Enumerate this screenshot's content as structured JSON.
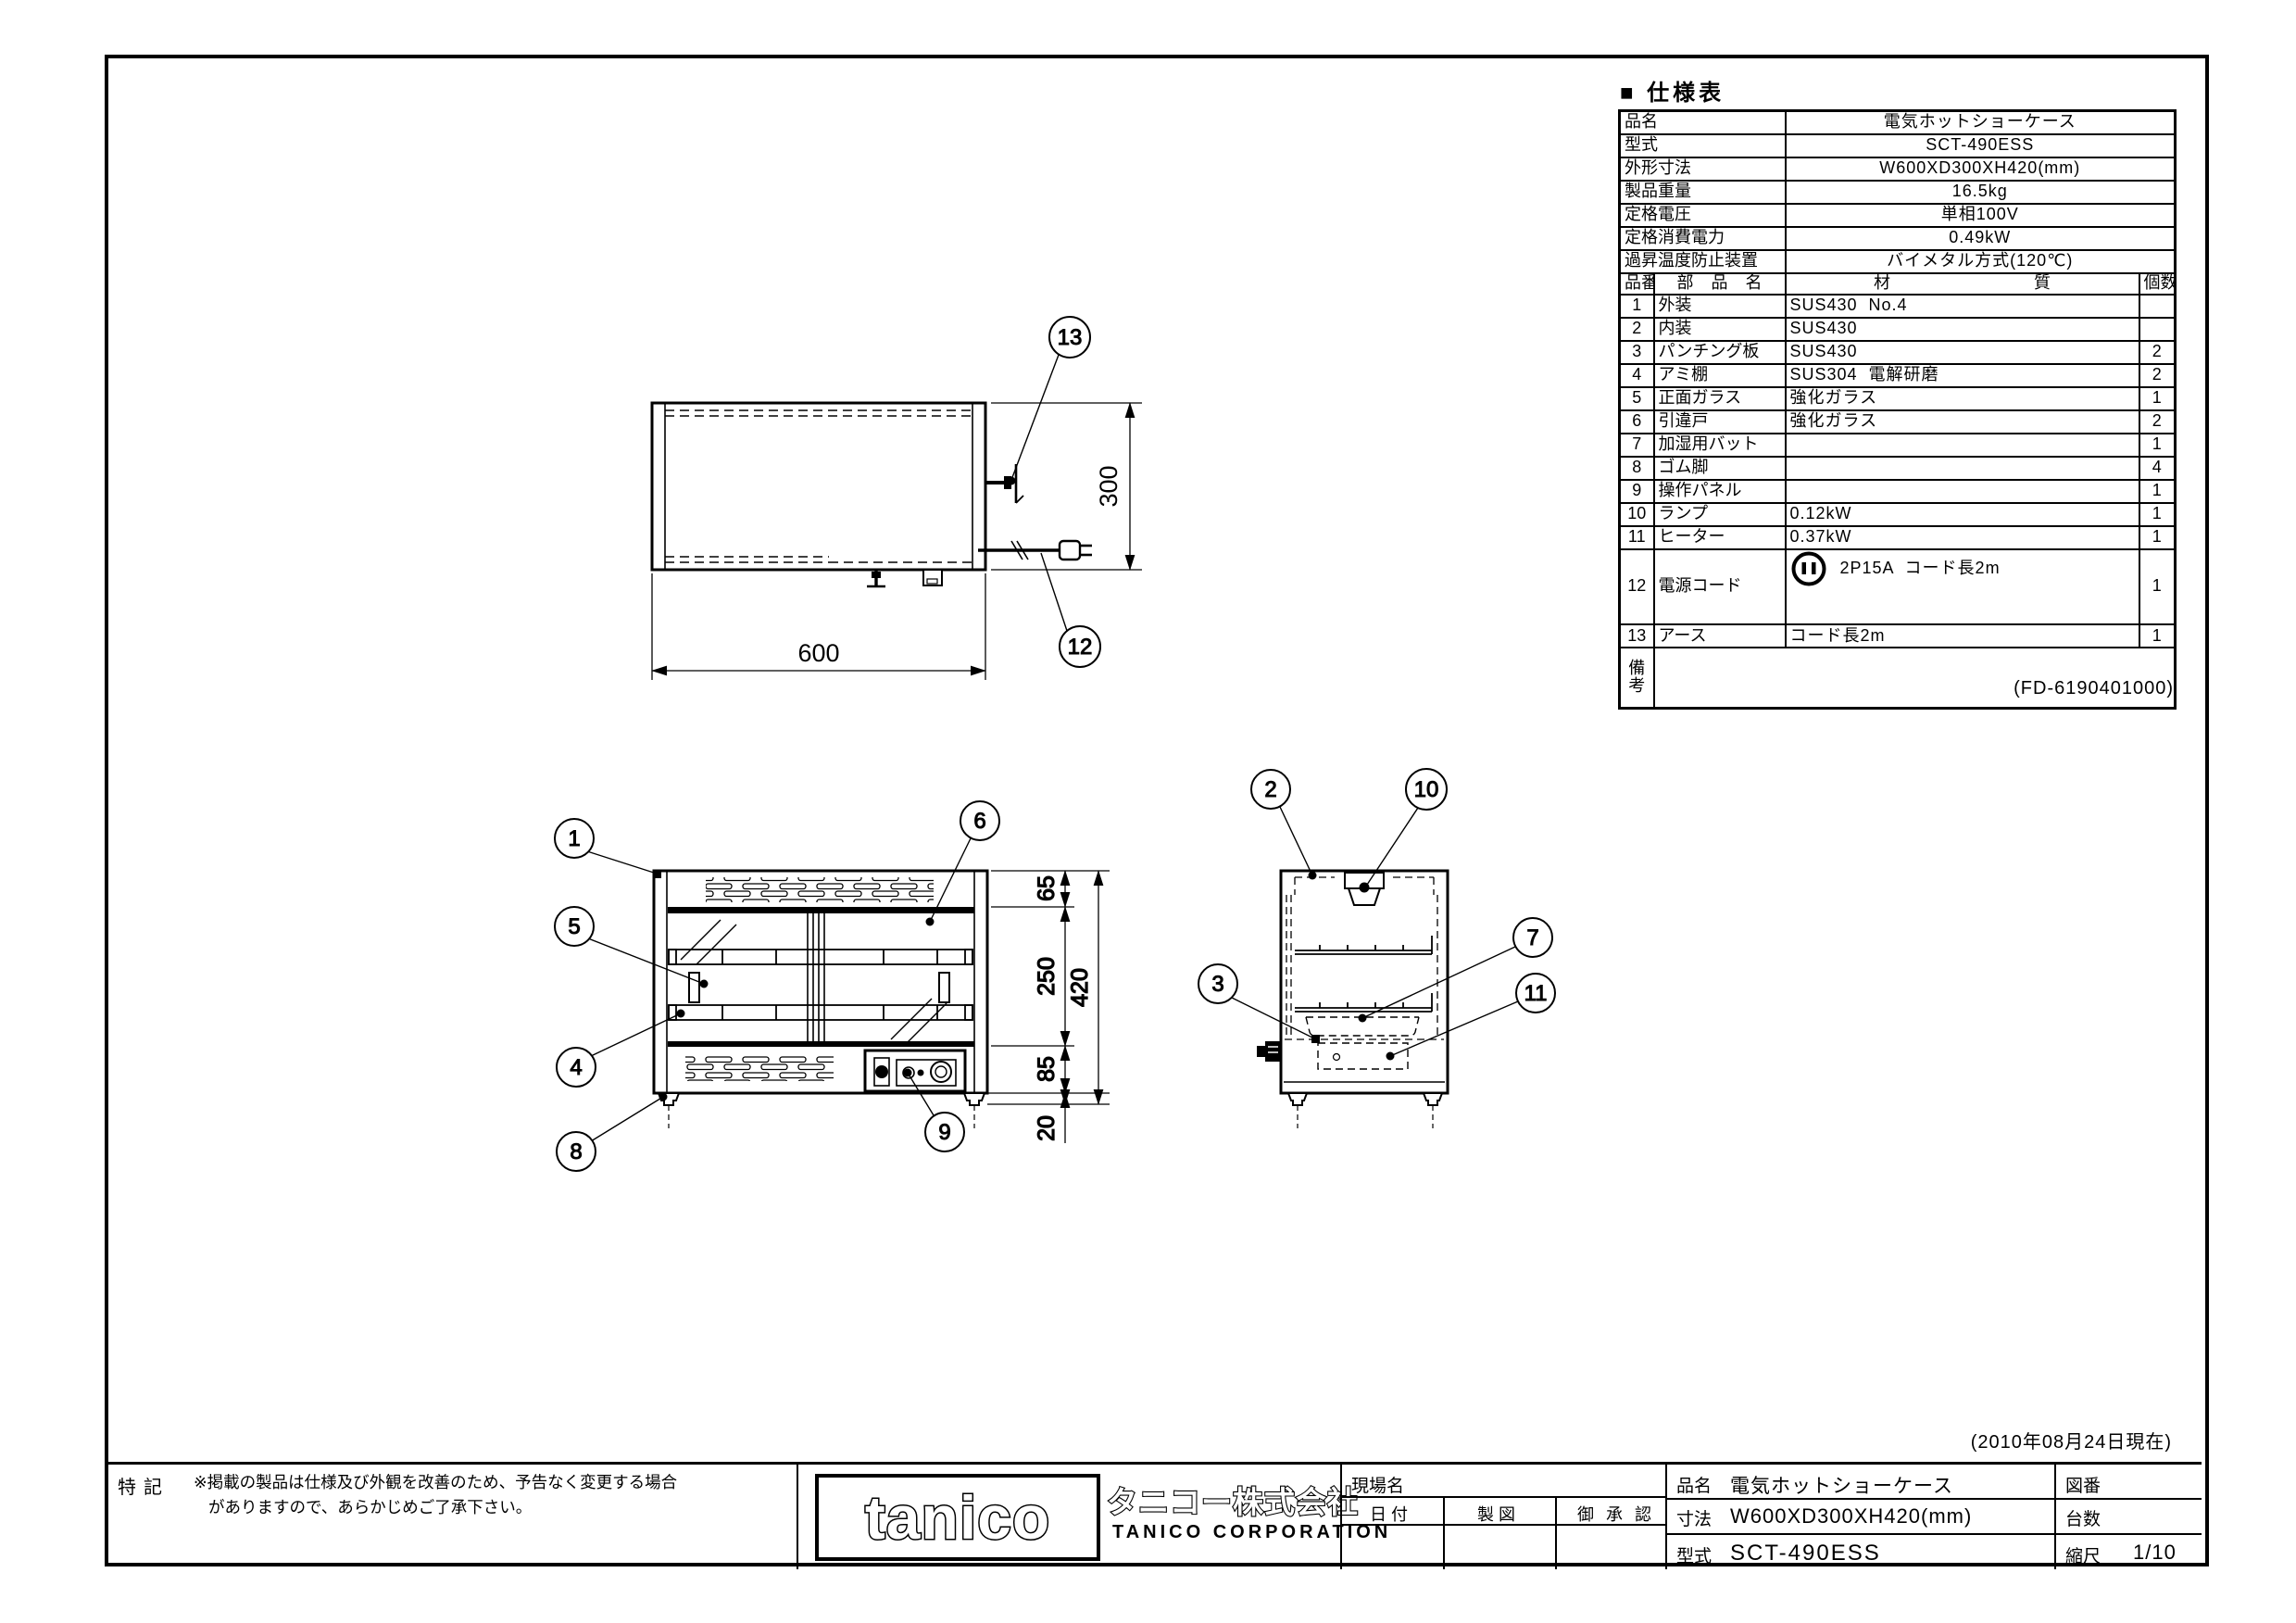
{
  "doc": {
    "spec_title": "■ 仕様表",
    "doc_code": "(FD-6190401000)",
    "as_of_date": "(2010年08月24日現在)"
  },
  "spec": {
    "info_rows": [
      {
        "label": "品名",
        "value": "電気ホットショーケース"
      },
      {
        "label": "型式",
        "value": "SCT-490ESS"
      },
      {
        "label": "外形寸法",
        "value": "W600XD300XH420(mm)"
      },
      {
        "label": "製品重量",
        "value": "16.5kg"
      },
      {
        "label": "定格電圧",
        "value": "単相100V"
      },
      {
        "label": "定格消費電力",
        "value": "0.49kW"
      },
      {
        "label": "過昇温度防止装置",
        "value": "バイメタル方式(120℃)"
      }
    ],
    "header": {
      "no": "品番",
      "name": "部 品 名",
      "material": "材 質",
      "qty": "個数"
    },
    "parts": [
      {
        "no": "1",
        "name": "外装",
        "material": "SUS430  No.4",
        "qty": ""
      },
      {
        "no": "2",
        "name": "内装",
        "material": "SUS430",
        "qty": ""
      },
      {
        "no": "3",
        "name": "パンチング板",
        "material": "SUS430",
        "qty": "2"
      },
      {
        "no": "4",
        "name": "アミ棚",
        "material": "SUS304  電解研磨",
        "qty": "2"
      },
      {
        "no": "5",
        "name": "正面ガラス",
        "material": "強化ガラス",
        "qty": "1"
      },
      {
        "no": "6",
        "name": "引違戸",
        "material": "強化ガラス",
        "qty": "2"
      },
      {
        "no": "7",
        "name": "加湿用バット",
        "material": "",
        "qty": "1"
      },
      {
        "no": "8",
        "name": "ゴム脚",
        "material": "",
        "qty": "4"
      },
      {
        "no": "9",
        "name": "操作パネル",
        "material": "",
        "qty": "1"
      },
      {
        "no": "10",
        "name": "ランプ",
        "material": "0.12kW",
        "qty": "1"
      },
      {
        "no": "11",
        "name": "ヒーター",
        "material": "0.37kW",
        "qty": "1"
      },
      {
        "no": "12",
        "name": "電源コード",
        "material": "2P15A  コード長2m",
        "qty": "1"
      },
      {
        "no": "13",
        "name": "アース",
        "material": "コード長2m",
        "qty": "1"
      }
    ],
    "remarks_label": "備\n考"
  },
  "dims": {
    "w600": "600",
    "d300": "300",
    "h65": "65",
    "h250": "250",
    "h85": "85",
    "h20": "20",
    "h420": "420"
  },
  "balloons": {
    "n1": "1",
    "n2": "2",
    "n3": "3",
    "n4": "4",
    "n5": "5",
    "n6": "6",
    "n7": "7",
    "n8": "8",
    "n9": "9",
    "n10": "10",
    "n11": "11",
    "n12": "12",
    "n13": "13"
  },
  "title_block": {
    "tokki_label": "特記",
    "note_line1": "※掲載の製品は仕様及び外観を改善のため、予告なく変更する場合",
    "note_line2": "がありますので、あらかじめご了承下さい。",
    "logo_text": "tanico",
    "company_jp": "タニコー株式会社",
    "company_en": "TANICO  CORPORATION",
    "site_label": "現場名",
    "date_label": "日 付",
    "draft_label": "製 図",
    "approval_label": "御 承 認",
    "hinmei_label": "品名",
    "hinmei_value": "電気ホットショーケース",
    "sunpo_label": "寸法",
    "sunpo_value": "W600XD300XH420(mm)",
    "katashiki_label": "型式",
    "katashiki_value": "SCT-490ESS",
    "zuban_label": "図番",
    "zuban_value": "",
    "daisu_label": "台数",
    "daisu_value": "",
    "shukushaku_label": "縮尺",
    "shukushaku_value": "1/10"
  }
}
